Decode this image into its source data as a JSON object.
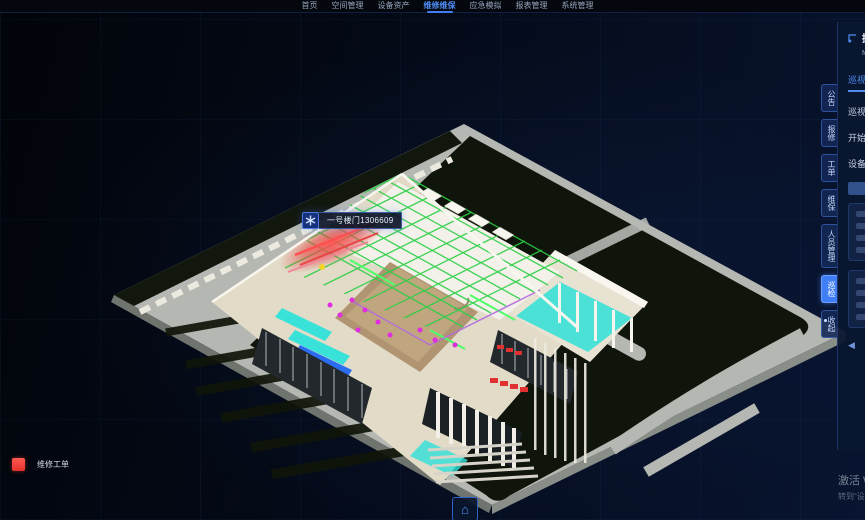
{
  "nav": {
    "items": [
      {
        "label": "首页",
        "active": false
      },
      {
        "label": "空间管理",
        "active": false
      },
      {
        "label": "设备资产",
        "active": false
      },
      {
        "label": "维修维保",
        "active": true
      },
      {
        "label": "应急模拟",
        "active": false
      },
      {
        "label": "报表管理",
        "active": false
      },
      {
        "label": "系统管理",
        "active": false
      }
    ]
  },
  "scene": {
    "tooltip": {
      "text": "一号楼门1306609"
    }
  },
  "legend": {
    "swatch_color": "#f0403c",
    "label": "维修工单"
  },
  "icons": {
    "home": "⌂",
    "collapse": "◀",
    "tooltip_marker": "snowflake"
  },
  "right_panel": {
    "tabs": [
      {
        "label": "公告",
        "active": false
      },
      {
        "label": "报修",
        "active": false
      },
      {
        "label": "工单",
        "active": false
      },
      {
        "label": "维保",
        "active": false
      },
      {
        "label": "人员管理",
        "active": false
      },
      {
        "label": "巡检",
        "active": true
      },
      {
        "label": "收起",
        "active": false
      }
    ],
    "header": {
      "title": "操作",
      "subtitle": "Ma"
    },
    "active_subtab": "巡视",
    "menu_rows": [
      "巡视路线",
      "开始时间",
      "设备台账"
    ]
  },
  "watermark": {
    "line1": "激活 W",
    "line2": "转到“设"
  },
  "colors": {
    "nav_active": "#4f8df5",
    "panel_tab_active": "#3f7ef5",
    "alert_red": "#f0403c",
    "mep_green": "#2bcf45",
    "mep_cyan": "#2fe3da",
    "mep_magenta": "#e02ce0",
    "platform_gray": "#b5b8b2",
    "landscape_dark": "#10150b"
  }
}
